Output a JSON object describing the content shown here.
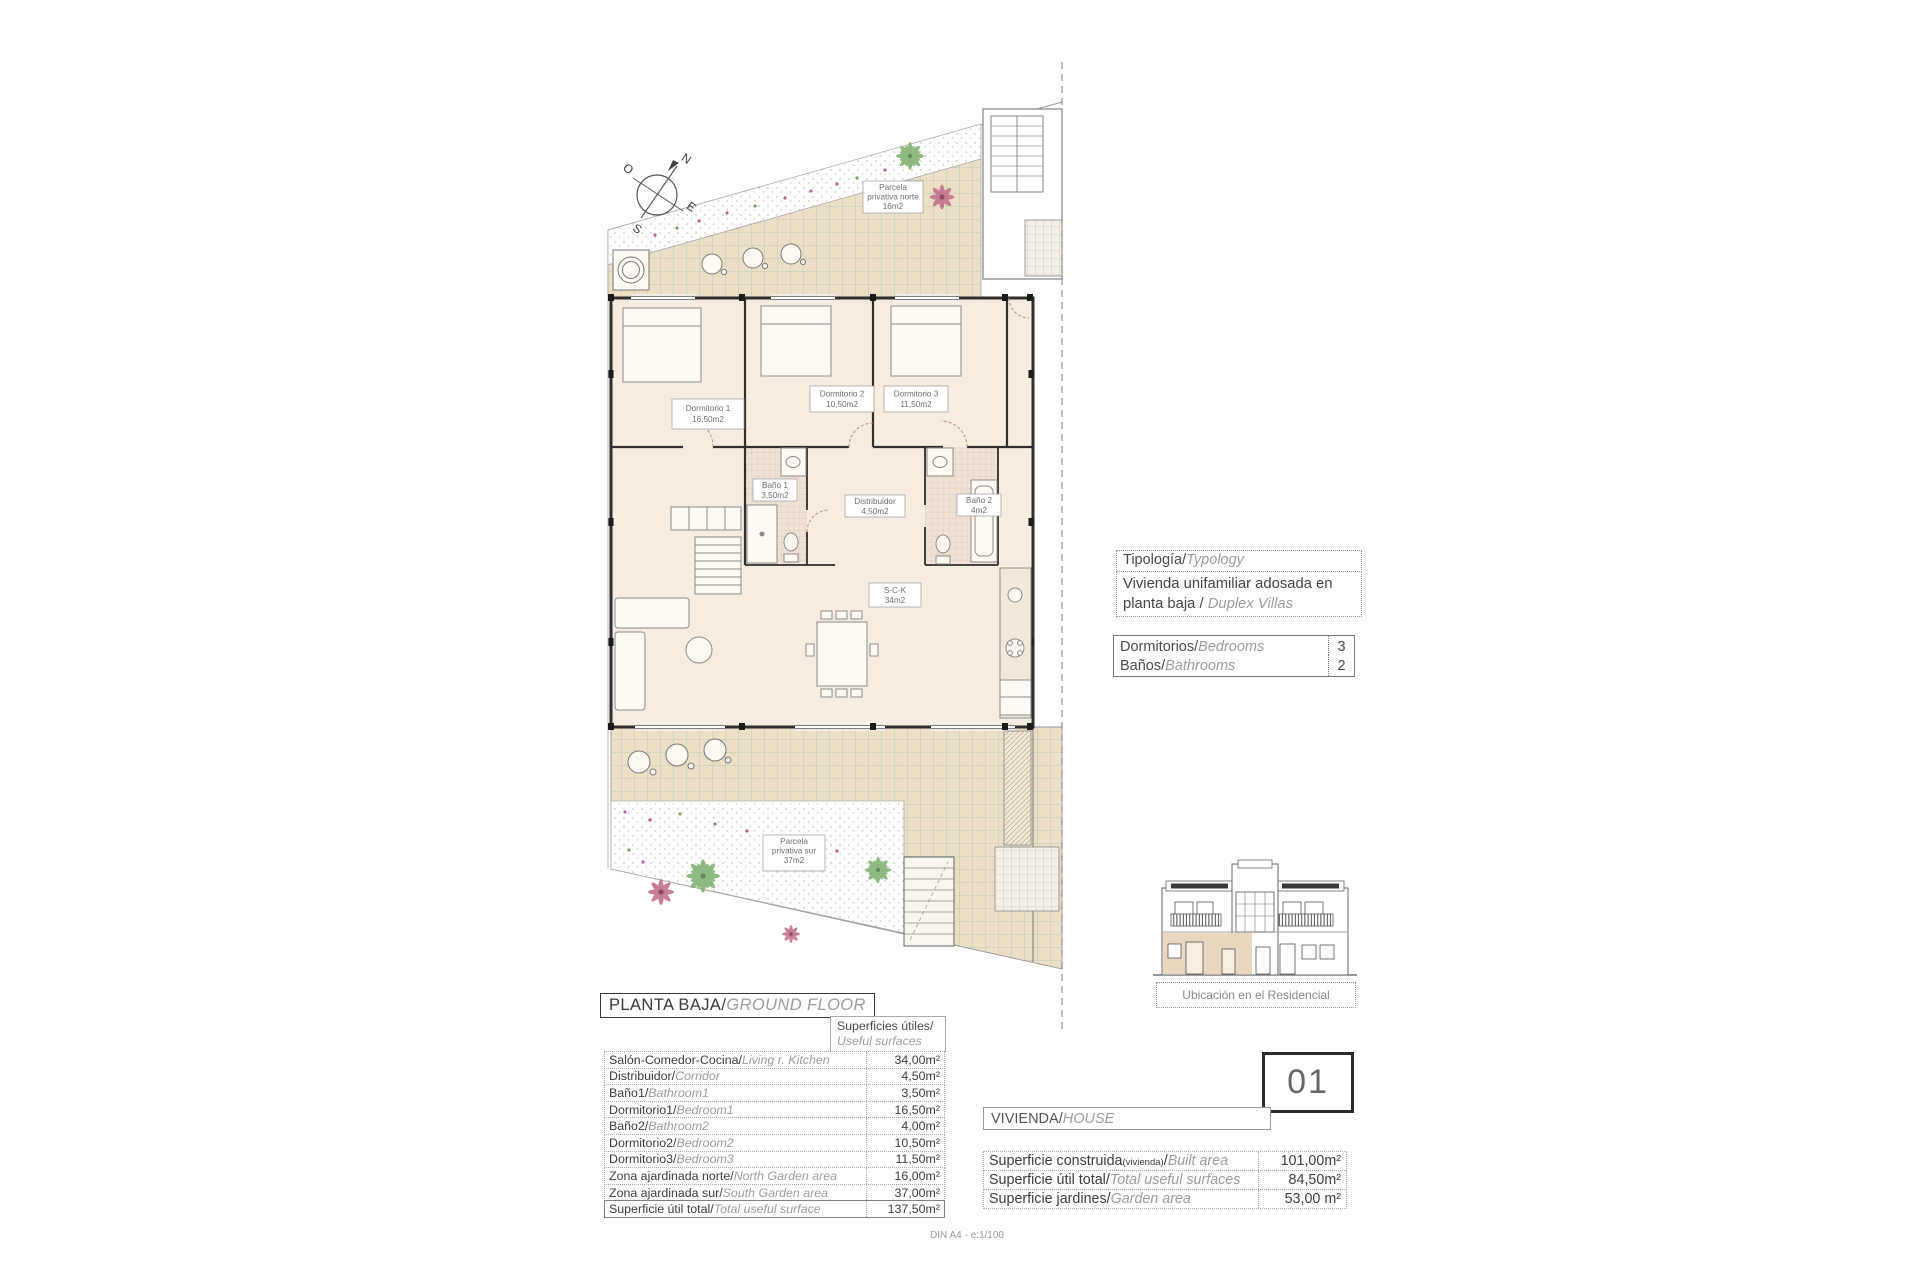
{
  "plan": {
    "compass": {
      "n": "N",
      "e": "E",
      "s": "S",
      "o": "O"
    },
    "labels": {
      "parcela_norte": {
        "l1": "Parcela",
        "l2": "privativa norte",
        "l3": "16m2"
      },
      "dorm1": {
        "l1": "Dormitorio 1",
        "l2": "16,50m2"
      },
      "dorm2": {
        "l1": "Dormitorio 2",
        "l2": "10,50m2"
      },
      "dorm3": {
        "l1": "Dormitorio 3",
        "l2": "11,50m2"
      },
      "bano1": {
        "l1": "Baño 1",
        "l2": "3,50m2"
      },
      "distribuidor": {
        "l1": "Distribuidor",
        "l2": "4,50m2"
      },
      "bano2": {
        "l1": "Baño 2",
        "l2": "4m2"
      },
      "sck": {
        "l1": "S-C-K",
        "l2": "34m2"
      },
      "parcela_sur": {
        "l1": "Parcela",
        "l2": "privativa sur",
        "l3": "37m2"
      }
    }
  },
  "typology": {
    "header": {
      "es": "Tipología",
      "sep": "/",
      "en": "Typology"
    },
    "value": {
      "es": "Vivienda unifamiliar adosada en planta baja ",
      "sep": "/ ",
      "en": "Duplex Villas"
    },
    "rows": [
      {
        "es": "Dormitorios",
        "sep": "/",
        "en": "Bedrooms",
        "value": "3"
      },
      {
        "es": "Baños",
        "sep": "/",
        "en": "Bathrooms",
        "value": "2"
      }
    ]
  },
  "location": {
    "caption": "Ubicación en el Residencial"
  },
  "ground_floor": {
    "title": {
      "es": "PLANTA BAJA",
      "sep": "/",
      "en": "GROUND FLOOR"
    },
    "surfaces_header": {
      "es": "Superficies útiles",
      "sep": "/",
      "en": "Useful surfaces"
    },
    "rows": [
      {
        "es": "Salón-Comedor-Cocina",
        "sep": "/",
        "en": "Living r. Kitchen",
        "value": "34,00m²"
      },
      {
        "es": "Distribuidor",
        "sep": "/",
        "en": "Corridor",
        "value": "4,50m²"
      },
      {
        "es": "Baño1",
        "sep": "/",
        "en": "Bathroom1",
        "value": "3,50m²"
      },
      {
        "es": "Dormitorio1",
        "sep": "/",
        "en": "Bedroom1",
        "value": "16,50m²"
      },
      {
        "es": "Baño2",
        "sep": "/",
        "en": "Bathroom2",
        "value": "4,00m²"
      },
      {
        "es": "Dormitorio2",
        "sep": "/",
        "en": "Bedroom2",
        "value": "10,50m²"
      },
      {
        "es": "Dormitorio3",
        "sep": "/",
        "en": "Bedroom3",
        "value": "11,50m²"
      },
      {
        "es": "Zona ajardinada norte",
        "sep": "/",
        "en": "North Garden area",
        "value": "16,00m²"
      },
      {
        "es": "Zona ajardinada sur",
        "sep": "/",
        "en": "South Garden area",
        "value": "37,00m²"
      },
      {
        "es": "Superficie útil total",
        "sep": "/",
        "en": "Total useful surface",
        "value": "137,50m²"
      }
    ]
  },
  "house": {
    "number": "01",
    "label": {
      "es": "VIVIENDA",
      "sep": "/",
      "en": "HOUSE"
    },
    "rows": [
      {
        "es": "Superficie construida",
        "small": "(vivienda)",
        "sep": "/",
        "en": "Built area",
        "value": "101,00m²"
      },
      {
        "es": "Superficie útil total",
        "small": "",
        "sep": "/",
        "en": "Total useful surfaces",
        "value": "84,50m²"
      },
      {
        "es": "Superficie jardines",
        "small": "",
        "sep": "/",
        "en": "Garden area",
        "value": "53,00 m²"
      }
    ]
  },
  "footer": "DIN A4 - e:1/100"
}
